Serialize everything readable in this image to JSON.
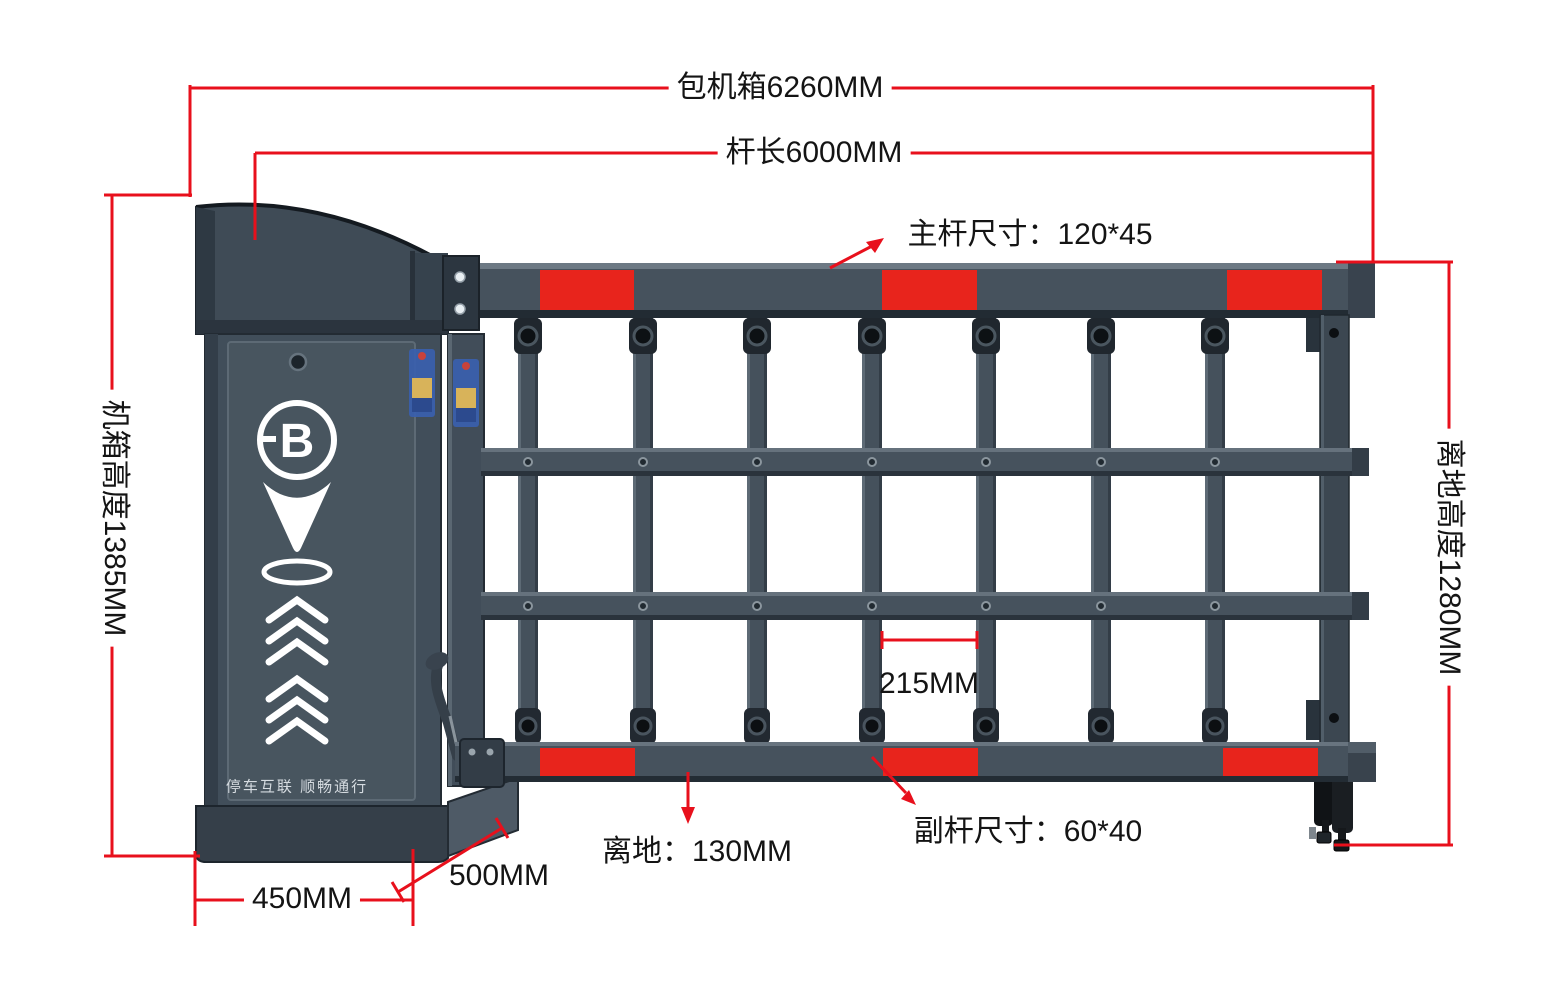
{
  "page": {
    "type": "barrier-gate-dimension-diagram",
    "background": "#ffffff"
  },
  "colors": {
    "dimension_red": "#e8101c",
    "reflective_stripe_red": "#e8241c",
    "gate_slate": "#46525d",
    "gate_dark_edge": "#252e36",
    "gate_highlight": "#6d7984",
    "label_text": "#141414",
    "logo_white": "#ffffff",
    "slogan_gray": "#d5dbe0",
    "foot_black": "#15181b"
  },
  "labels": {
    "overall_length": "包机箱6260MM",
    "arm_length": "杆长6000MM",
    "main_arm_size": "主杆尺寸：120*45",
    "cabinet_height": "机箱高度1385MM",
    "clearance_height": "离地高度1280MM",
    "picket_gap": "215MM",
    "ground_clearance": "离地：130MM",
    "sub_arm_size": "副杆尺寸：60*40",
    "cabinet_width": "450MM",
    "cabinet_depth": "500MM"
  },
  "cabinet": {
    "slogan": "停车互联 顺畅通行",
    "logo_letter": "B"
  }
}
